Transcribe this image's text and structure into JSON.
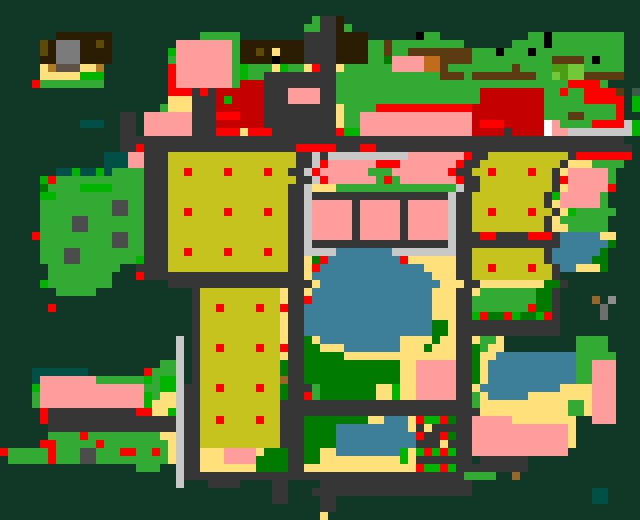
{
  "map": {
    "name": "pixel-town-map",
    "cols": 80,
    "rows": 65,
    "cell_size": 8,
    "palette": {
      ".": "#113826",
      "g": "#33aa33",
      "G": "#00b400",
      "F": "#007a00",
      "L": "#72c838",
      "m": "#4b9e14",
      "d": "#363636",
      "D": "#4c4c4c",
      "s": "#c8c8c8",
      "y": "#ffe07a",
      "o": "#c6c31f",
      "p": "#ff9c9c",
      "r": "#ff0000",
      "R": "#c40000",
      "b": "#3d7e99",
      "t": "#005048",
      "k": "#000000",
      "B": "#2a1d04",
      "n": "#5c3a12",
      "N": "#b07b28",
      "O": "#5c4a06",
      "h": "#96662a",
      "u": "#c06c1c",
      "e": "#7b7b7b",
      "w": "#ffffff",
      "q": "#5e5148",
      "x": "#6e6e6e",
      "X": "#8e8e8e",
      "v": "#3c5a4a"
    },
    "legend": {
      ".": "forest-background",
      "g": "grass",
      "G": "bright-grass",
      "F": "dark-lawn",
      "L": "park-tile-light",
      "m": "park-tile-dark",
      "d": "road",
      "D": "rock",
      "s": "sidewalk",
      "y": "sand",
      "o": "field-block",
      "p": "pink-building",
      "r": "red-marker",
      "R": "red-building",
      "b": "pond-water",
      "t": "deep-water",
      "k": "black-detail",
      "B": "dark-brown-building",
      "n": "wood-brown",
      "N": "tan-door",
      "O": "olive-roof-detail",
      "h": "small-brown-object",
      "u": "orange-door",
      "e": "gray-roof",
      "w": "white-detail",
      "q": "porch-gray",
      "x": "stone-gray",
      "X": "stone-light",
      "v": "slate-bush"
    },
    "grid": [
      "................................................................................",
      "................................................................................",
      ".......................................gddB.....................................",
      "......................................ggddBg....................................",
      ".......BBBBBBB...........ggggg........ddddBBBB......kgg...........ggkggggggggg..",
      ".....OBeeeBBOB........pppppppgBBBBBBBBddddBBBBggnggggggggg......ggggkggggggggg..",
      ".....OBeeeBBBB.......GpppppppgBBOByBBBddddBBBBggnggnnnnnnnngggkgggkggggggggggg..",
      ".....BBeeeBBBB.......gpppppppgBBBBkBBBddddBBBBggFppppuunnnnggggggggggnnnngkggg..",
      ".....yNqqqyyN........rpppppppgGgggyGggyrddygggggg ppppuunggggggggngggg mmLLggggg..",
      ".....yyyyyGGG........rpppppppgGggdddddddddgggggggggggggnnngnnnnnnnnggLmLLnnnnn..",
      "....rgggggggg........rpppppppgRRRdddddddddgggggggggggggggggggggggggggggrrrrg....",
      ".....................rrrdrdRRRRRRdddppppddggggggggggggggggggRRRRRRRRggrggrrrrn.v",
      ".....................yyydddRGRRRRdddppppddggggggggggggggggggRRRRRRRRgggggrrrrr.G",
      "....................gyyydddRRRRRRdddddddddygggg rrrrrrrrrrrrRRRRRRRRRgggggggggr.G",
      "...............dd.ppppppdddrrrRRRdddddddddyggppppppppppppppRRRRRRRRRgggnngggg r..",
      "..........ttt..dd.ppppppdddRRRRRRdddddddddyggppppppppppppppRrrrRRRRRwpggggrrrrsG",
      "...............dd.ppppppdddrrryrrrddddddddrGGppppppppppppppRRRRdRRRRwppssssssssG",
      "...............dddddddddddddddddddddddddddddddddddddddddddddddddddddddddddddd d.",
      "...............ddrdddddddddddddddddddrrrrrdddrrdddddddddddddddddddddddddddddddd.",
      ".............tttppdddooooooooooooooooddsdsssssssssspppppppr ddooooooooood rrrrrrr...",
      ".............tttppdddooooooooooooooooddsrppppppr rrpppppppr ddooooooooood yyygggg...",
      ".......ttGttGtggggdddooroooorooooroodds rppppppgggpppppppr ddoorooooroodyp ppppg...",
      ".....Grgggggggggggdddooooooooooooooooddsrppppppgrgpppppppr ddooooooooodrpppppg...",
      ".....Fgggg GGGGggggdddooooooooooooooodd syyyggggggggggggggg sddooooooooodyp ppppr...",
      ".....GGgggggggggggdddooooooooooooooodd sdddddddddddddddddsddooooooooodGpppppg...",
      ".....gggggggggDDggdddooooooooooooooodd sppppp dpppppdpppppsddooooooooodyp ppppg...",
      ".....gggggggggDDggdddooroooorooooroodd sppppp dpppppdpppppsddoorooooroodyGggggg...",
      ".....ggggDDgggggggdddooooooooooooooodd sppppp dpppppdpppppsddooooooooodygggggg...",
      ".....ggggDDgggggggdddooooooooooooooodd sppppp dpppppdpppppsddooooooooodyyggggg...",
      "....rgggggggggDDggdddooooooooooooooodd sppppp dpppppdpppppsdddrrddddrrrdbbbbbyy...",
      ".....gggggggggDDggdddooooooooooooooodd sdddddddddddddddddsdddddddddddddbbbbbbF...",
      ".....gggDDggggggggdddooroooorooooroodd ssssbbbbbbbssssssssddooooooooodbbbbbbF...",
      ".....gggDDgggggggGdddoooooooooooooooddyFrbbbbbbbbbryyyyyyddooooooooodbbbbbFF...",
      "......ggggggggg..ddddoooooooooooooooddyrbbbbbbbbbbbbbyyyyddoorooooroodbbyyyF....",
      "......gggggggg...rddddddddddddddddddddybbbbbbbbbbbbbbbyyyddooooooooood..........",
      ".....Ggggggggg.......ddddddddddddddddddybbbbbbbbbbbbbbbyyyddyyyyyyyyFFd..........",
      ".......ggggg............dooooooooooyddybbbbbbbbbbbbbbbyyyddygggggggFFd..........",
      "........................dooooooooooyddrbbbbbbbbbbbbbbbyyyddggggggggFFd....h.X...",
      "......r.................doorooooroorddbbbbbbbbbbbbbbbbyyyddgggggggrFFd.....x....",
      "........................dooooooooooyddbbbbbbbbbbbbbbbbyyyddGrFFrGFFGrd.....x....",
      "........................dooooooooooyddbbbbbbbbbbbbbbbbFFyddddddddddddd..........",
      "........................dooooooooooyddbbbbbbbbbbbbbbbbFFyddddddddddddd..........",
      "......................s.dooooooooooyddFybbbbbbbbbbyyyyFyyddyggy.........gggg....",
      "......................s.doorooooroorddFFyyybbbbbbbyyyFyyyddFgyy.........gggg....",
      "......................s.dooooooooooyddFFFFFyyyyyyyyyyyyyyddFyybbbbbbbbbbggggg...",
      "....................ggs.dooooooooooFddFFFFFFFFFFFFyyppppp ddFybbbbbbbbbbbggppp...",
      "....ttttttt.......rggg s.dooooooooooFddFFFFFFFFFFFFyyppppp ddFybbbbbbbbbbbggppp...",
      "....tpppppppggggggGgGGs.doooooooooohddFFFFFFFFFFFFyyppppp ddFybbbbbbbbbbbggppp...",
      "....GpppppppppppppggGGsddoorooooroo FdddgFFFFFFFyyGyyppppp ddybbbbbbbbbbyyyyppp...",
      "....gpppppppppppppGgyysddoooooooooo FddrgFFFFFFFyyGyyppppp ddgybbbbbyyyyyyyyppp...",
      "....gpppppppppppppGyyysddoooooooooo ddddddddddddddddddddddddgyyyyyyyyyyyggyppp...",
      ".....rdddddddddddrryyGsddoooooooooo dddddddddddddddddddddddddyyyyyyyyyyyggyppp...",
      ".....rddddddddddddddddsddoorooooroo dddFFFFFFFFyybbbyrGGrFddpppppyyyyyyyy..ppp...",
      "......ddddddddddddddddsddoooooooooo dddFFFFbbbbbbbbbydydddddpppppppppppp y........",
      "......ggggrgggggggggyysddoooooooooo dddFFFFbbbbbbbbbbrddrFddpppppppppppp y........",
      ".....rrgggggrggggggggysddoooooooooo dddFFFFbbbbbbbbbbdddyddd pppppppppppp y........",
      "rgggggrgggDDgggrrggrgysddyyypppp yFFFddFFyybbbbbbbbGyGrGrGddpppppppppppp.........",
      ".gggggrgggDDgggggggggysddyyypppp FFFFddFFyyyyyyyyyyGydddddd d.dddddd..............",
      ".................ggg..sddyyyyyyyFFFFddyyyyyyyyyyyyyyrGGrGddddddddd..............",
      "......................sddddddddddddddddddddddddddddddddddd gggg..h..............",
      "......................s...dddd....dd....ddddddddddddddddddd.....................",
      "..................................dd...dddddddddddddddddddd...............tt....",
      "..................................dd....dd................................tt....",
      "........................................dd......................................",
      "........................................y......................................."
    ]
  }
}
